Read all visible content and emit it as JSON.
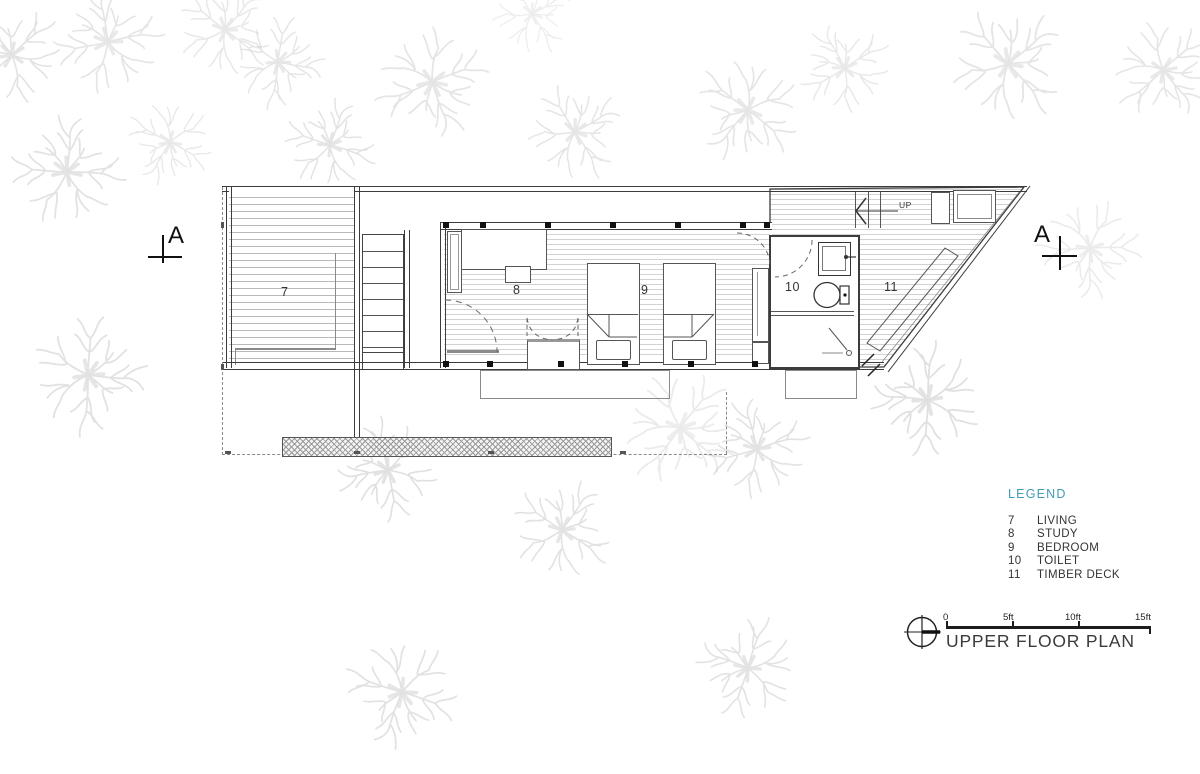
{
  "drawing": {
    "title": "UPPER FLOOR PLAN",
    "legend": {
      "heading": "LEGEND",
      "items": [
        {
          "number": "7",
          "label": "LIVING"
        },
        {
          "number": "8",
          "label": "STUDY"
        },
        {
          "number": "9",
          "label": "BEDROOM"
        },
        {
          "number": "10",
          "label": "TOILET"
        },
        {
          "number": "11",
          "label": "TIMBER DECK"
        }
      ]
    },
    "rooms": {
      "living": "7",
      "study": "8",
      "bedroom": "9",
      "toilet": "10",
      "timber_deck": "11"
    },
    "stair_label": "UP",
    "section_markers": {
      "left": "A",
      "right": "A"
    },
    "scale_bar": {
      "ticks": [
        "0",
        "5ft",
        "10ft",
        "15ft"
      ]
    },
    "colors": {
      "legend_heading": "#3f9eb5",
      "plan_lines": "#3c3c3c",
      "floor_stripes": "#c9c9c9",
      "trees": "#d2d2d2"
    }
  }
}
